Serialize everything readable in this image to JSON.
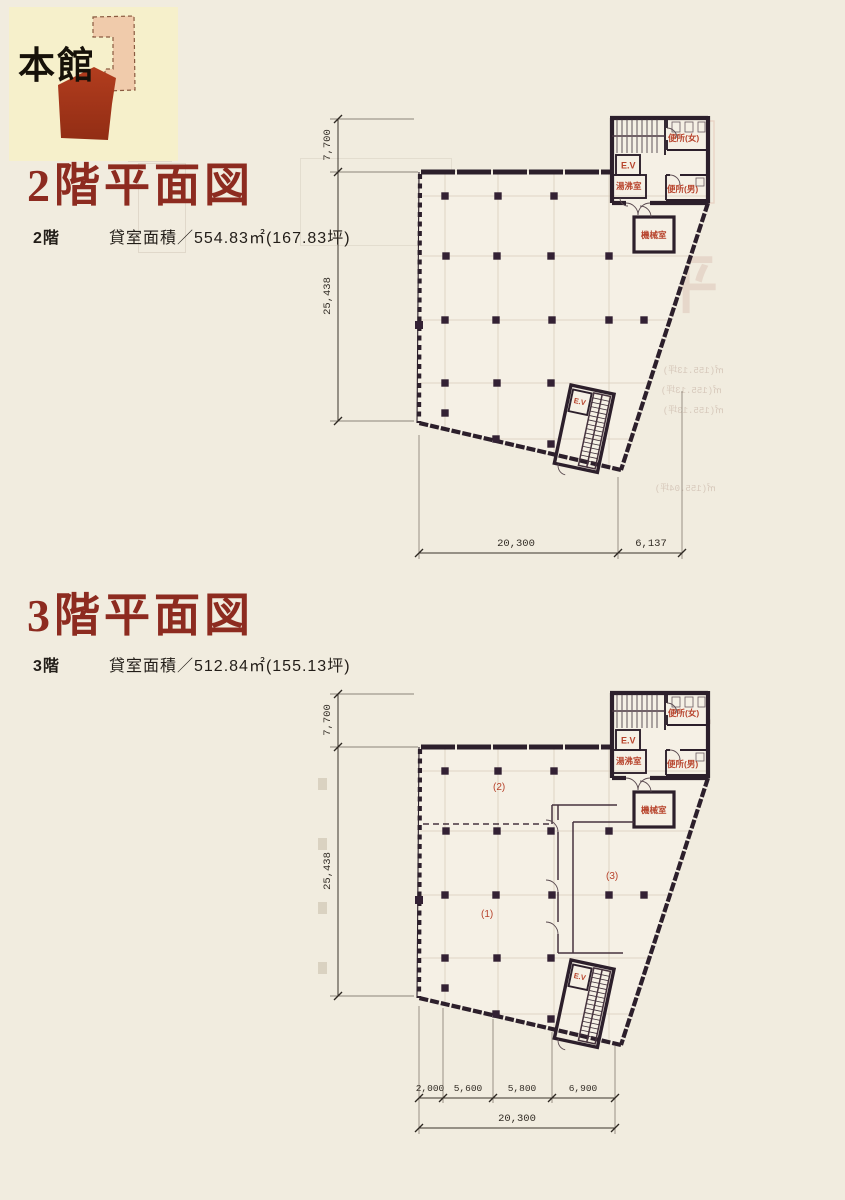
{
  "page": {
    "bg": "#f1ecdf"
  },
  "key_card": {
    "label": "本館",
    "accent_color": "#b03a1c",
    "light_shape_color": "#f0cbab"
  },
  "floors": [
    {
      "title": "2階平面図",
      "floor_label": "2階",
      "area_label": "貸室面積／554.83㎡(167.83坪)",
      "dims": {
        "depth_core": "7,700",
        "depth_main": "25,438",
        "width_main": "20,300",
        "width_right": "6,137"
      },
      "rooms": {
        "stair_ev": "E.V",
        "wc_w": "便所(女)",
        "wc_m": "便所(男)",
        "kettle": "湯沸室",
        "machine": "機械室",
        "ev2": "E.V"
      }
    },
    {
      "title": "3階平面図",
      "floor_label": "3階",
      "area_label": "貸室面積／512.84㎡(155.13坪)",
      "dims": {
        "depth_core": "7,700",
        "depth_main": "25,438",
        "w1": "2,000",
        "w2": "5,600",
        "w3": "5,800",
        "w4": "6,900",
        "width_total": "20,300"
      },
      "rooms": {
        "stair_ev": "E.V",
        "wc_w": "便所(女)",
        "wc_m": "便所(男)",
        "kettle": "湯沸室",
        "machine": "機械室",
        "ev2": "E.V"
      },
      "zones": {
        "z1": "(1)",
        "z2": "(2)",
        "z3": "(3)"
      }
    }
  ],
  "bleed": {
    "kanji": "平面図",
    "line_a": "㎡(155.13坪)",
    "line_b": "㎡(155.04坪)"
  }
}
